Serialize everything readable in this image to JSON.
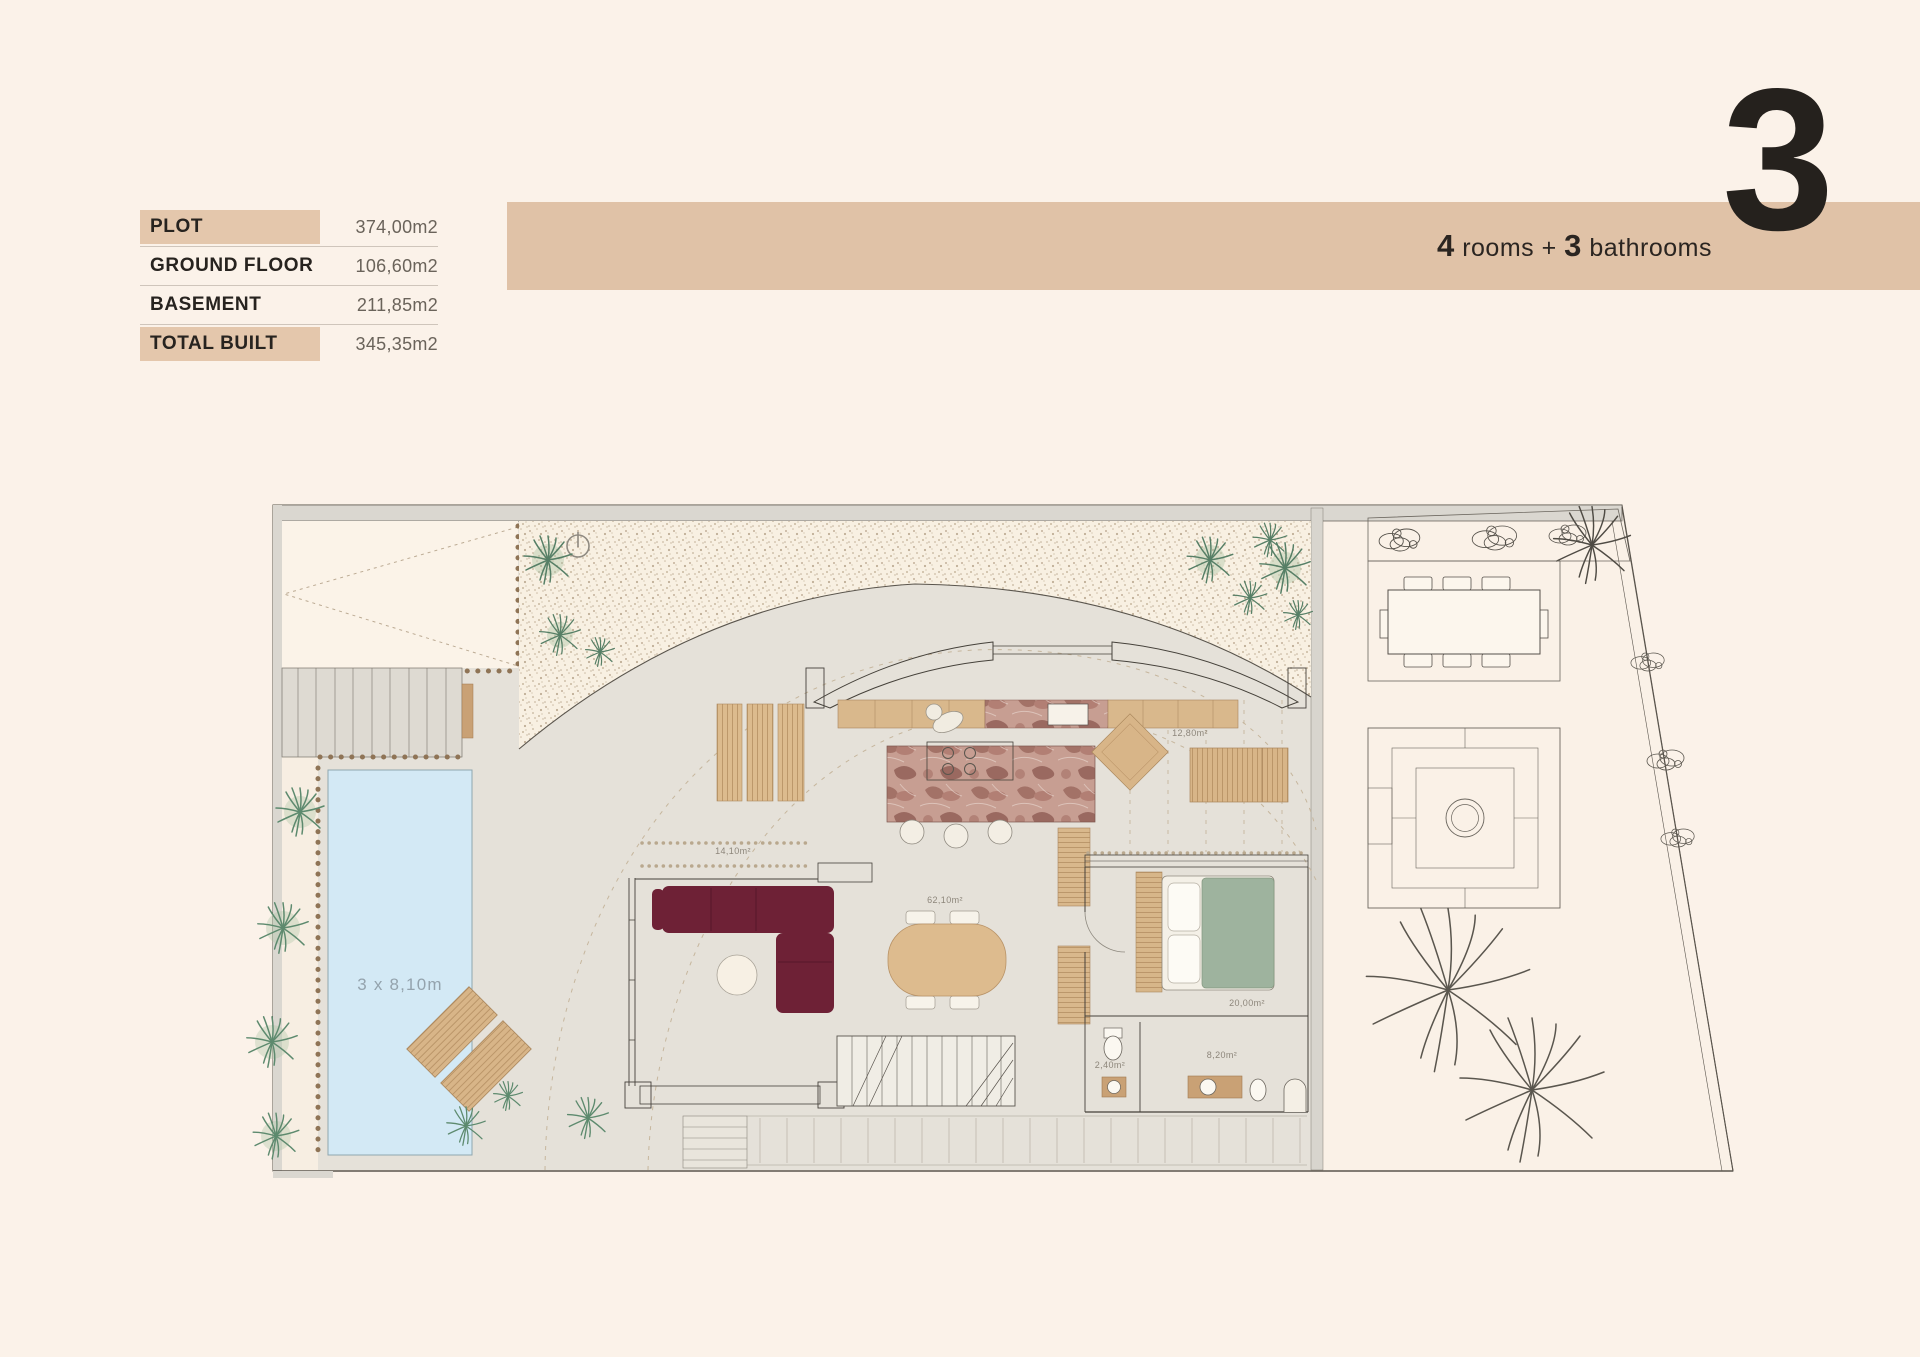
{
  "colors": {
    "page_bg": "#fbf2e9",
    "accent_band": "#e0c2a7",
    "table_highlight": "#e4c7ac",
    "pool_water": "#d3e9f5",
    "sofa": "#6e2136",
    "bed_duvet": "#9eb39e",
    "wood": "#d8b588",
    "ink": "#25211d"
  },
  "area_table": {
    "rows": [
      {
        "label": "PLOT",
        "value": "374,00m2",
        "highlight": true
      },
      {
        "label": "GROUND FLOOR",
        "value": "106,60m2",
        "highlight": false
      },
      {
        "label": "BASEMENT",
        "value": "211,85m2",
        "highlight": false
      },
      {
        "label": "TOTAL BUILT",
        "value": "345,35m2",
        "highlight": true
      }
    ]
  },
  "header": {
    "rooms_count": "4",
    "rooms_label": "rooms",
    "separator": "+",
    "bathrooms_count": "3",
    "bathrooms_label": "bathrooms",
    "unit_number": "3"
  },
  "floorplan": {
    "pool_label": "3 x 8,10m",
    "room_labels": [
      {
        "name": "terrace",
        "text": "14,10m²"
      },
      {
        "name": "living-room",
        "text": "62,10m²"
      },
      {
        "name": "side-terrace",
        "text": "12,80m²"
      },
      {
        "name": "bedroom",
        "text": "20,00m²"
      },
      {
        "name": "wc",
        "text": "2,40m²"
      },
      {
        "name": "bathroom",
        "text": "8,20m²"
      }
    ]
  }
}
